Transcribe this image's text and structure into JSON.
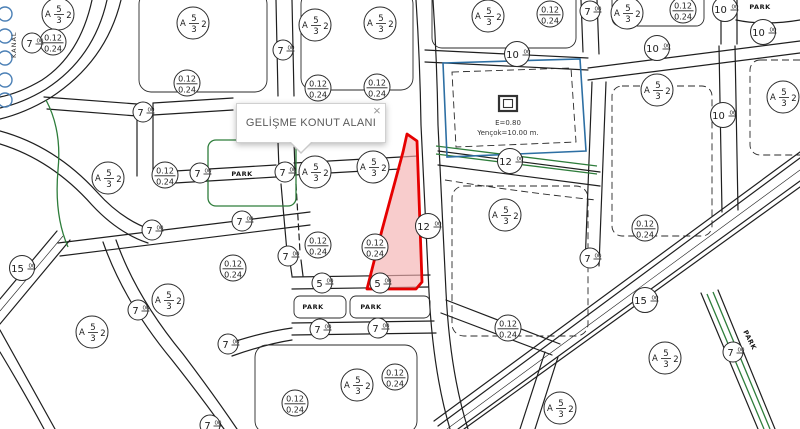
{
  "tooltip": {
    "text": "GELİŞME KONUT ALANI",
    "close_label": "×"
  },
  "labels": {
    "park": "PARK",
    "kanal": "KANAL",
    "zoning": {
      "prefix": "A",
      "numerator": "5",
      "denominator": "3",
      "floors": "2"
    },
    "ratio": {
      "numerator": "0.12",
      "denominator": "0.24"
    },
    "road_superscript": "00"
  },
  "special_parcel": {
    "line1": "E=0.80",
    "line2": "Yençok=10.00 m."
  },
  "colors": {
    "selected_fill": "#f5b0b0",
    "selected_stroke": "#e60000",
    "special_outline": "#2d6fa3",
    "park_green": "#2e7d3b",
    "water_blue": "#4a7fb5",
    "line": "#1f1f1f"
  },
  "map": {
    "zoning_circles": [
      {
        "x": 58,
        "y": 14
      },
      {
        "x": 193,
        "y": 23
      },
      {
        "x": 315,
        "y": 25
      },
      {
        "x": 380,
        "y": 23
      },
      {
        "x": 488,
        "y": 16
      },
      {
        "x": 627,
        "y": 13
      },
      {
        "x": 657,
        "y": 90
      },
      {
        "x": 783,
        "y": 97
      },
      {
        "x": 108,
        "y": 178
      },
      {
        "x": 315,
        "y": 172
      },
      {
        "x": 373,
        "y": 167
      },
      {
        "x": 505,
        "y": 215
      },
      {
        "x": 168,
        "y": 300
      },
      {
        "x": 92,
        "y": 332
      },
      {
        "x": 357,
        "y": 385
      },
      {
        "x": 665,
        "y": 358
      },
      {
        "x": 560,
        "y": 408
      }
    ],
    "ratio_circles": [
      {
        "x": 53,
        "y": 42
      },
      {
        "x": 187,
        "y": 83
      },
      {
        "x": 318,
        "y": 88
      },
      {
        "x": 377,
        "y": 87
      },
      {
        "x": 550,
        "y": 14
      },
      {
        "x": 683,
        "y": 10
      },
      {
        "x": 165,
        "y": 175
      },
      {
        "x": 233,
        "y": 268
      },
      {
        "x": 318,
        "y": 245
      },
      {
        "x": 375,
        "y": 247
      },
      {
        "x": 645,
        "y": 228
      },
      {
        "x": 508,
        "y": 328
      },
      {
        "x": 395,
        "y": 377
      },
      {
        "x": 295,
        "y": 403
      }
    ],
    "road_circles": [
      {
        "x": 32,
        "y": 43,
        "value": "7"
      },
      {
        "x": 143,
        "y": 112,
        "value": "7"
      },
      {
        "x": 283,
        "y": 50,
        "value": "7"
      },
      {
        "x": 590,
        "y": 11,
        "value": "7"
      },
      {
        "x": 200,
        "y": 173,
        "value": "7"
      },
      {
        "x": 285,
        "y": 172,
        "value": "7"
      },
      {
        "x": 152,
        "y": 230,
        "value": "7"
      },
      {
        "x": 242,
        "y": 221,
        "value": "7"
      },
      {
        "x": 288,
        "y": 256,
        "value": "7"
      },
      {
        "x": 138,
        "y": 310,
        "value": "7"
      },
      {
        "x": 228,
        "y": 344,
        "value": "7"
      },
      {
        "x": 320,
        "y": 329,
        "value": "7"
      },
      {
        "x": 378,
        "y": 328,
        "value": "7"
      },
      {
        "x": 590,
        "y": 258,
        "value": "7"
      },
      {
        "x": 733,
        "y": 352,
        "value": "7"
      },
      {
        "x": 210,
        "y": 425,
        "value": "7"
      },
      {
        "x": 322,
        "y": 283,
        "value": "5"
      },
      {
        "x": 380,
        "y": 283,
        "value": "5"
      },
      {
        "x": 517,
        "y": 54,
        "value": "10"
      },
      {
        "x": 657,
        "y": 48,
        "value": "10"
      },
      {
        "x": 725,
        "y": 9,
        "value": "10"
      },
      {
        "x": 763,
        "y": 32,
        "value": "10"
      },
      {
        "x": 723,
        "y": 115,
        "value": "10"
      },
      {
        "x": 510,
        "y": 161,
        "value": "12"
      },
      {
        "x": 428,
        "y": 226,
        "value": "12"
      },
      {
        "x": 22,
        "y": 268,
        "value": "15"
      },
      {
        "x": 645,
        "y": 300,
        "value": "15"
      }
    ],
    "park_labels": [
      {
        "x": 242,
        "y": 176,
        "rotate": 0
      },
      {
        "x": 760,
        "y": 9,
        "rotate": 0
      },
      {
        "x": 313,
        "y": 309,
        "rotate": 0
      },
      {
        "x": 371,
        "y": 309,
        "rotate": 0
      },
      {
        "x": 748,
        "y": 341,
        "rotate": 63
      }
    ]
  }
}
